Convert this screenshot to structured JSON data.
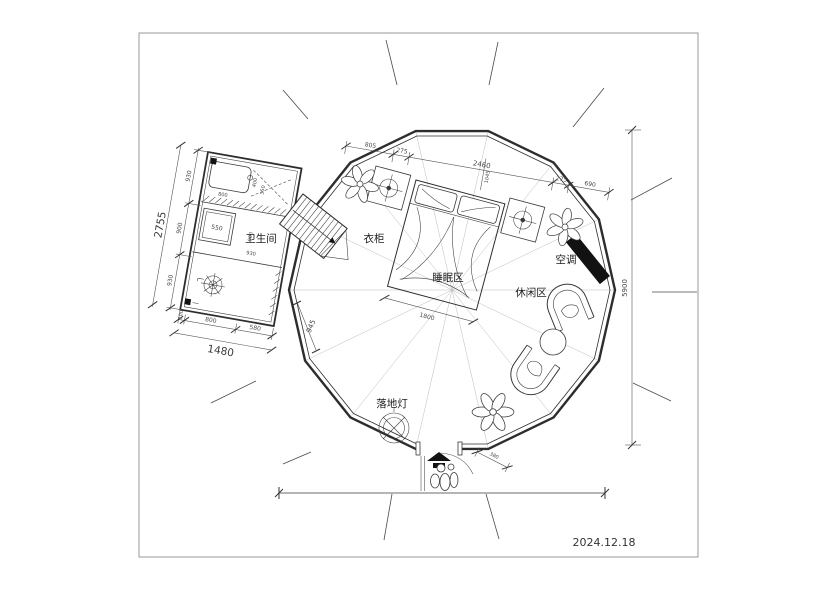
{
  "meta": {
    "date": "2024.12.18"
  },
  "rooms": {
    "bathroom": "卫生间",
    "wardrobe": "衣柜",
    "sleeping": "睡眠区",
    "leisure": "休闲区",
    "ac": "空调",
    "floor_lamp": "落地灯"
  },
  "dims": {
    "overall_height": "5900",
    "top_chain": [
      "805",
      "275",
      "2460",
      "275",
      "690"
    ],
    "top_perp": "1045",
    "bed_width": "1800",
    "entry_step": "380",
    "bath_left_chain": [
      "930",
      "900",
      "930"
    ],
    "bath_left_total": "2755",
    "bath_bottom_chain": [
      "100",
      "800",
      "580"
    ],
    "bath_bottom_total": "1480",
    "bath_diagonal": "945",
    "shower": "550",
    "bath_inner_900": "900",
    "bath_inner_930": "930",
    "bath_inner_800": "800",
    "bath_inner_400": "400",
    "bath_inner_350": "350"
  },
  "colors": {
    "line": "#333333",
    "dim": "#555555",
    "solid": "#111111",
    "frame": "#999999"
  }
}
